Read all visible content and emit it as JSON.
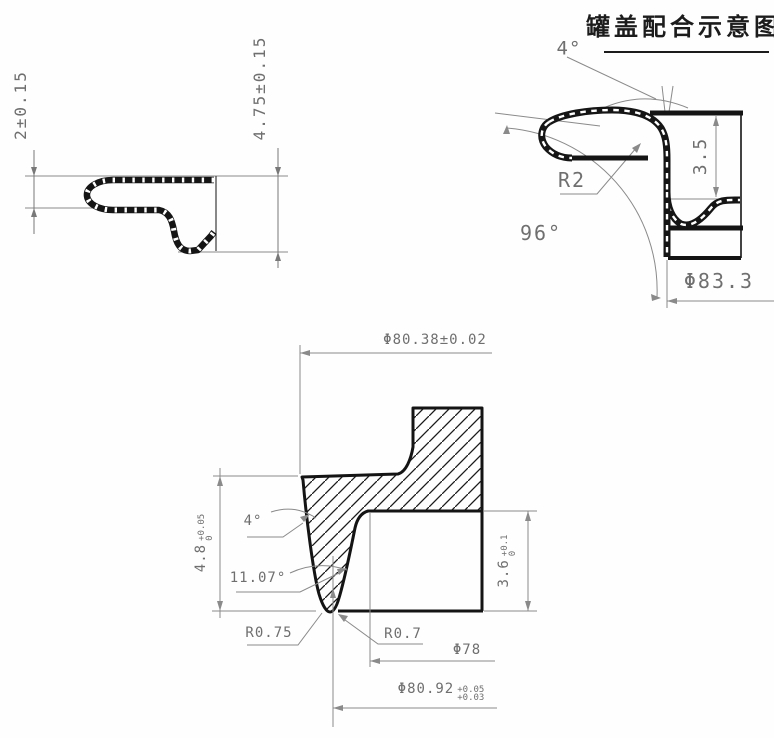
{
  "title": {
    "text": "罐盖配合示意图"
  },
  "colors": {
    "outline": "#1a1a1a",
    "dimension": "#6f6f6f"
  },
  "lid_profile": {
    "dim_curl_height": "2±0.15",
    "dim_total_height": "4.75±0.15"
  },
  "fit_detail": {
    "dim_chuck_angle": "4°",
    "dim_curl_radius": "R2",
    "dim_countersink_depth": "3.5",
    "dim_seam_angle": "96°",
    "dim_chuck_diameter": "Φ83.3"
  },
  "die_section": {
    "dim_top_diameter": "Φ80.38±0.02",
    "dim_groove_depth": "4.8",
    "groove_depth_tol_upper": "+0.05",
    "groove_depth_tol_lower": "0",
    "dim_wall_angle": "4°",
    "dim_flank_angle": "11.07°",
    "dim_tip_radius": "R0.75",
    "dim_corner_radius": "R0.7",
    "dim_inner_diameter": "Φ78",
    "dim_groove_diameter": "Φ80.92",
    "groove_dia_tol_upper": "+0.05",
    "groove_dia_tol_lower": "+0.03",
    "dim_step_depth": "3.6",
    "step_depth_tol_upper": "+0.1",
    "step_depth_tol_lower": "0"
  }
}
